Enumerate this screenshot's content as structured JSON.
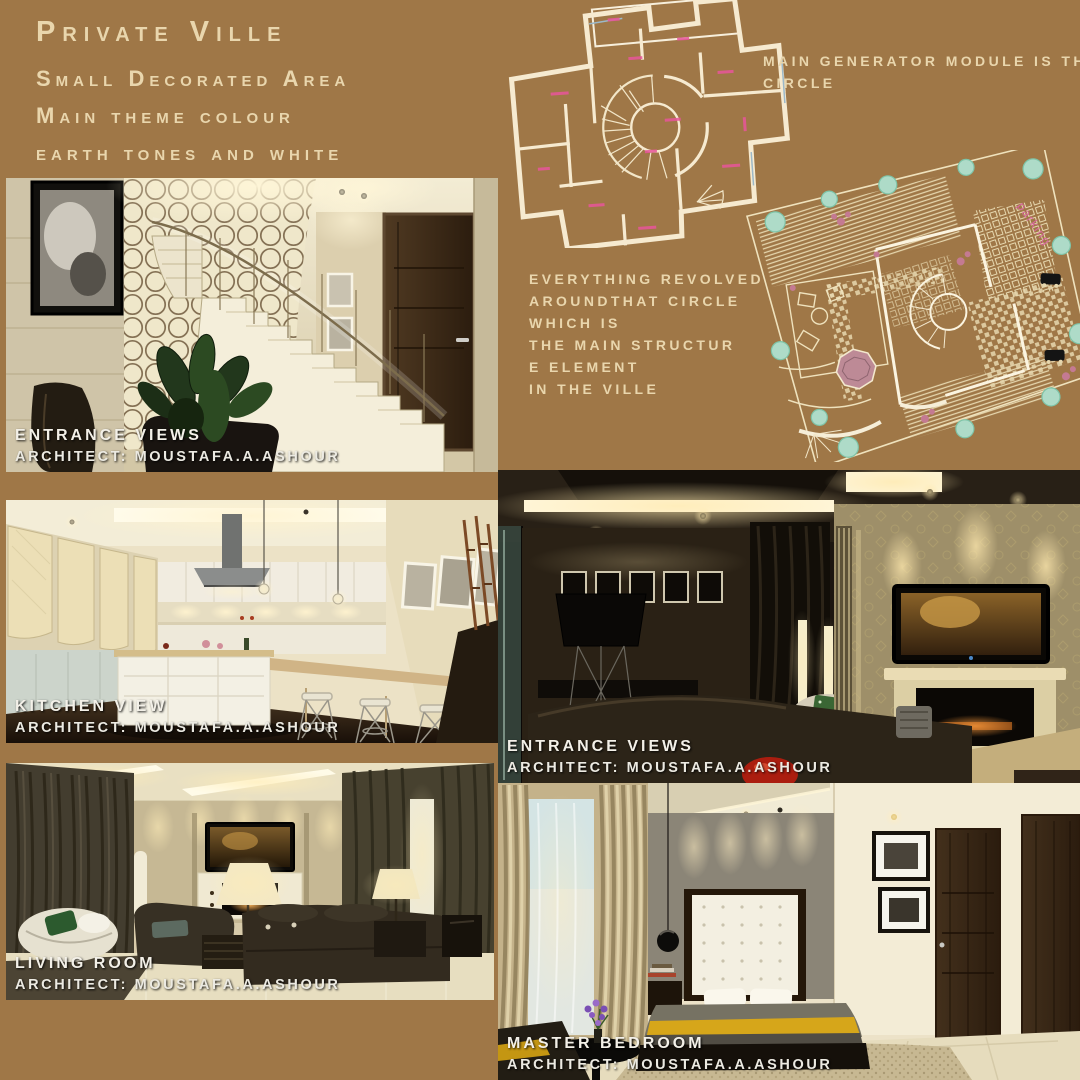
{
  "poster": {
    "background_color": "#9f7747",
    "title": "Private Ville",
    "subtitles": [
      "Small Decorated Area",
      "Main theme colour",
      "earth tones and white"
    ],
    "floor_plan_note_lines": [
      "MAIN GENERATOR MODULE IS THE",
      "CIRCLE"
    ],
    "site_plan_note_lines": [
      "EVERYTHING REVOLVED",
      "AROUNDTHAT CIRCLE",
      "WHICH IS",
      "THE MAIN STRUCTUR",
      "E ELEMENT",
      "IN THE VILLE"
    ],
    "site_plan_parking_label": "parking",
    "gallery": [
      {
        "title": "ENTRANCE VIEWS",
        "credit": "ARCHITECT: MOUSTAFA.A.ASHOUR"
      },
      {
        "title": "KITCHEN VIEW",
        "credit": "ARCHITECT: MOUSTAFA.A.ASHOUR"
      },
      {
        "title": "LIVING ROOM",
        "credit": "ARCHITECT: MOUSTAFA.A.ASHOUR"
      },
      {
        "title": "ENTRANCE VIEWS",
        "credit": "ARCHITECT: MOUSTAFA.A.ASHOUR"
      },
      {
        "title": "MASTER BEDROOM",
        "credit": "ARCHITECT: MOUSTAFA.A.ASHOUR"
      }
    ],
    "colors": {
      "text_cream": "#e9d6ad",
      "caption_white": "#f3f0e8",
      "plan_wall_cream": "#f6ead0",
      "plan_label_pink": "#e8559b",
      "tree_teal": "#aedbc8",
      "gazebo_mauve": "#bd8a96",
      "bed_throw_yellow": "#d6a61a",
      "decor_red": "#ab1d0f"
    }
  }
}
